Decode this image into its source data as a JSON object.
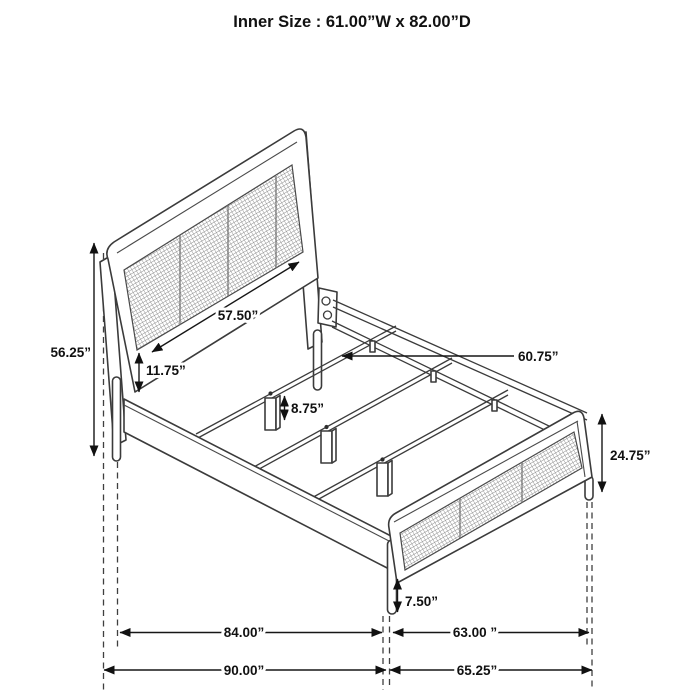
{
  "title": "Inner Size : 61.00”W x 82.00”D",
  "diagram": {
    "type": "furniture-dimension-drawing",
    "subject": "cane-panel bed frame, isometric line drawing",
    "labels": {
      "headboard_width": "57.50”",
      "headboard_height": "56.25”",
      "headboard_rail_gap": "11.75”",
      "slat_rail_length": "60.75”",
      "center_leg_height": "8.75”",
      "footboard_height": "24.75”",
      "footboard_leg_height": "7.50”",
      "frame_length": "84.00”",
      "footboard_span": "63.00 ”",
      "overall_length": "90.00”",
      "overall_width": "65.25”"
    },
    "colors": {
      "line": "#3b3b3b",
      "dimension_text": "#111111",
      "mesh": "#8a8a8a",
      "background": "#ffffff"
    }
  }
}
